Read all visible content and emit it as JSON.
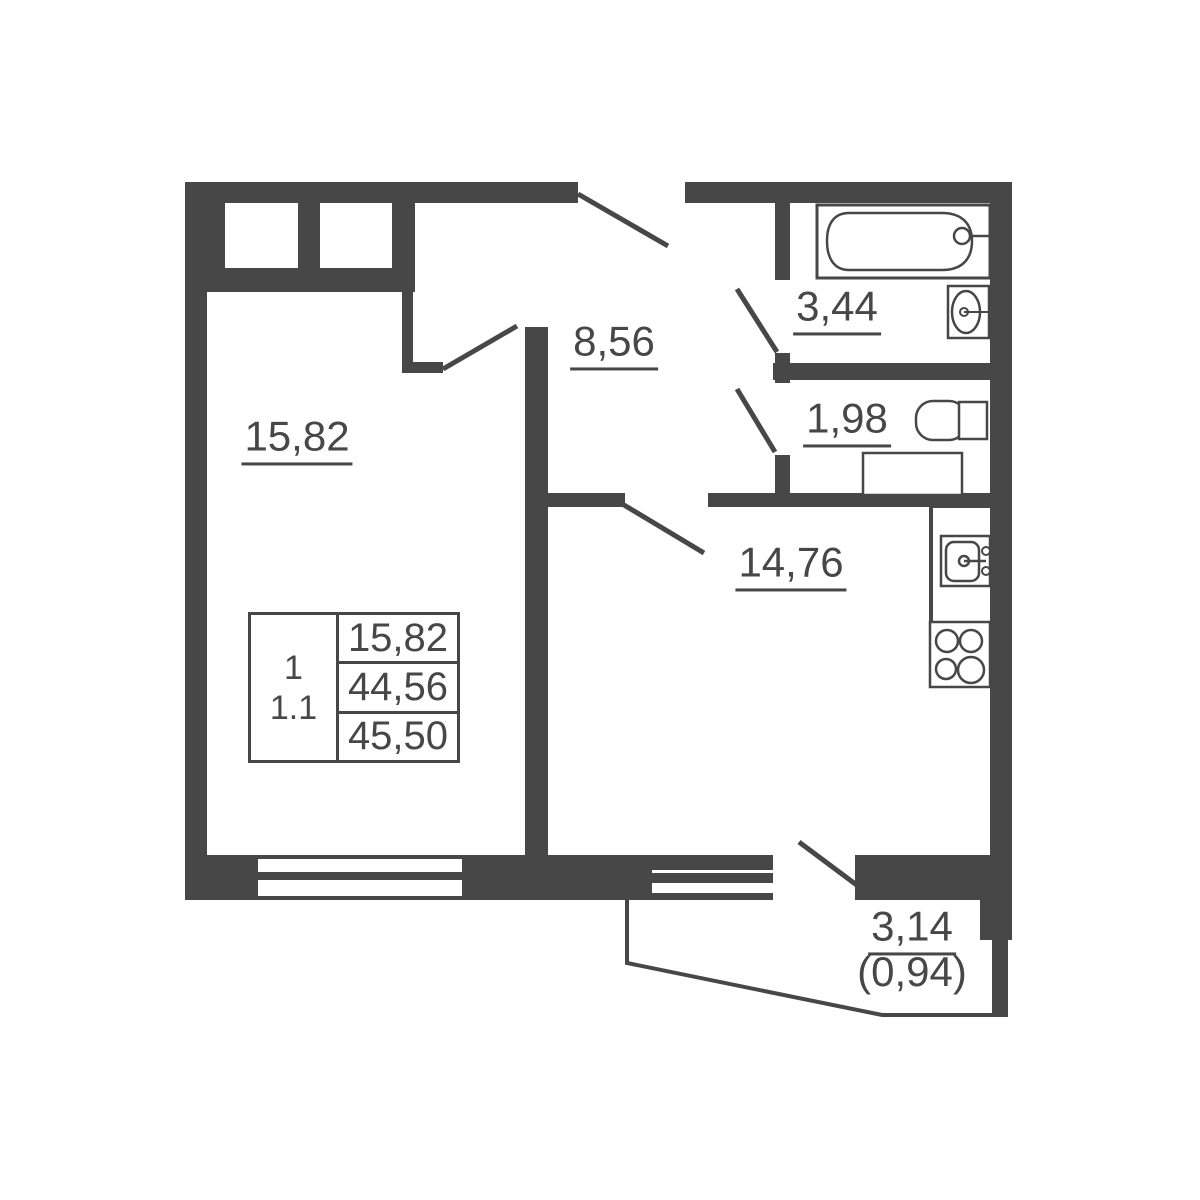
{
  "plan": {
    "colors": {
      "wall": "#474747",
      "background": "#ffffff"
    },
    "labels": {
      "living": "15,82",
      "hallway": "8,56",
      "bath": "3,44",
      "wc": "1,98",
      "kitchen": "14,76",
      "balcony": "3,14",
      "balcony_reduced": "(0,94)"
    },
    "table": {
      "rooms": "1",
      "type": "1.1",
      "living_area": "15,82",
      "area_without_balcony": "44,56",
      "total_area": "45,50"
    }
  }
}
